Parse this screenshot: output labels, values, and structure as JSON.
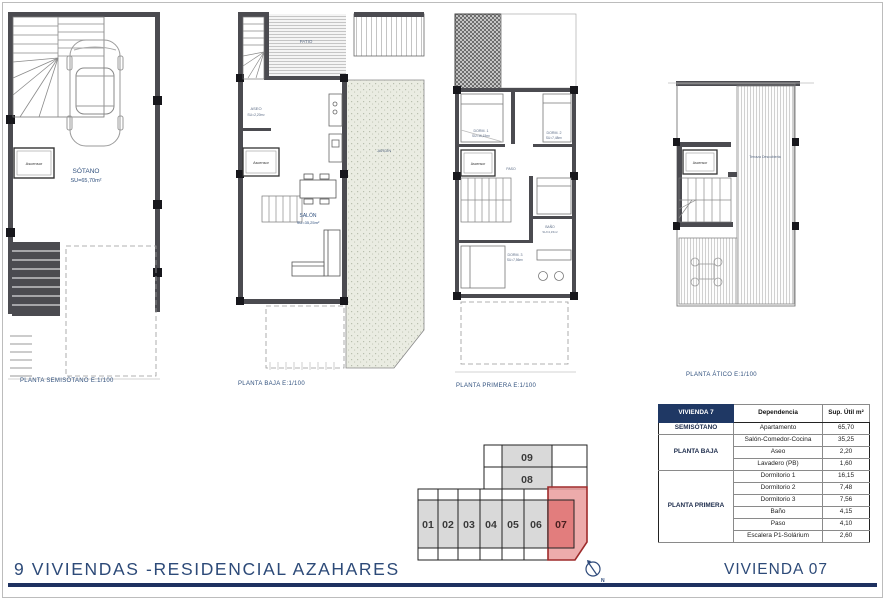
{
  "titles": {
    "project": "9 VIVIENDAS -RESIDENCIAL AZAHARES",
    "unit": "VIVIENDA 07"
  },
  "plans": {
    "semisotano": {
      "caption": "PLANTA SEMISÓTANO  E:1/100",
      "room": "SÓTANO",
      "area": "SU=65,70m²",
      "lift": "Ascensor"
    },
    "baja": {
      "caption": "PLANTA BAJA  E:1/100",
      "patio": "PATIO",
      "aseo": "ASEO",
      "aseo_area": "SU=2,20m²",
      "salon": "SALÓN",
      "salon_area": "SU=35,25m²",
      "jardin": "JARDÍN",
      "lift": "Ascensor"
    },
    "primera": {
      "caption": "PLANTA PRIMERA  E:1/100",
      "dorm1": "DORM. 1",
      "dorm1_area": "SU=16,15m²",
      "dorm2": "DORM. 2",
      "dorm2_area": "SU=7,48m²",
      "dorm3": "DORM. 3",
      "dorm3_area": "SU=7,56m²",
      "bano": "BAÑO",
      "bano_area": "SU=4,15m²",
      "paso": "PASO",
      "lift": "Ascensor"
    },
    "atico": {
      "caption": "PLANTA ÁTICO  E:1/100",
      "terrace": "Terraza Descubierta",
      "lift": "Ascensor"
    }
  },
  "site_key": {
    "units": [
      "01",
      "02",
      "03",
      "04",
      "05",
      "06",
      "07"
    ],
    "upper": [
      "09",
      "08"
    ],
    "highlighted_unit": "07",
    "north_label": "N"
  },
  "table": {
    "header": {
      "unit": "VIVIENDA 7",
      "dependencia": "Dependencia",
      "sup": "Sup. Útil m²"
    },
    "floors": {
      "semisotano": "SEMISÓTANO",
      "baja": "PLANTA BAJA",
      "primera": "PLANTA PRIMERA"
    },
    "rows": [
      {
        "name": "Apartamento",
        "value": "65,70"
      },
      {
        "name": "Salón-Comedor-Cocina",
        "value": "35,25"
      },
      {
        "name": "Aseo",
        "value": "2,20"
      },
      {
        "name": "Lavadero (PB)",
        "value": "1,60"
      },
      {
        "name": "Dormitorio 1",
        "value": "16,15"
      },
      {
        "name": "Dormitorio 2",
        "value": "7,48"
      },
      {
        "name": "Dormitorio 3",
        "value": "7,56"
      },
      {
        "name": "Baño",
        "value": "4,15"
      },
      {
        "name": "Paso",
        "value": "4,10"
      },
      {
        "name": "Escalera P1-Solárium",
        "value": "2,60"
      }
    ]
  },
  "colors": {
    "navy": "#1f3864",
    "title_navy": "#2d4a78",
    "highlight_red": "#d9534f",
    "wall": "#4b4b50"
  }
}
